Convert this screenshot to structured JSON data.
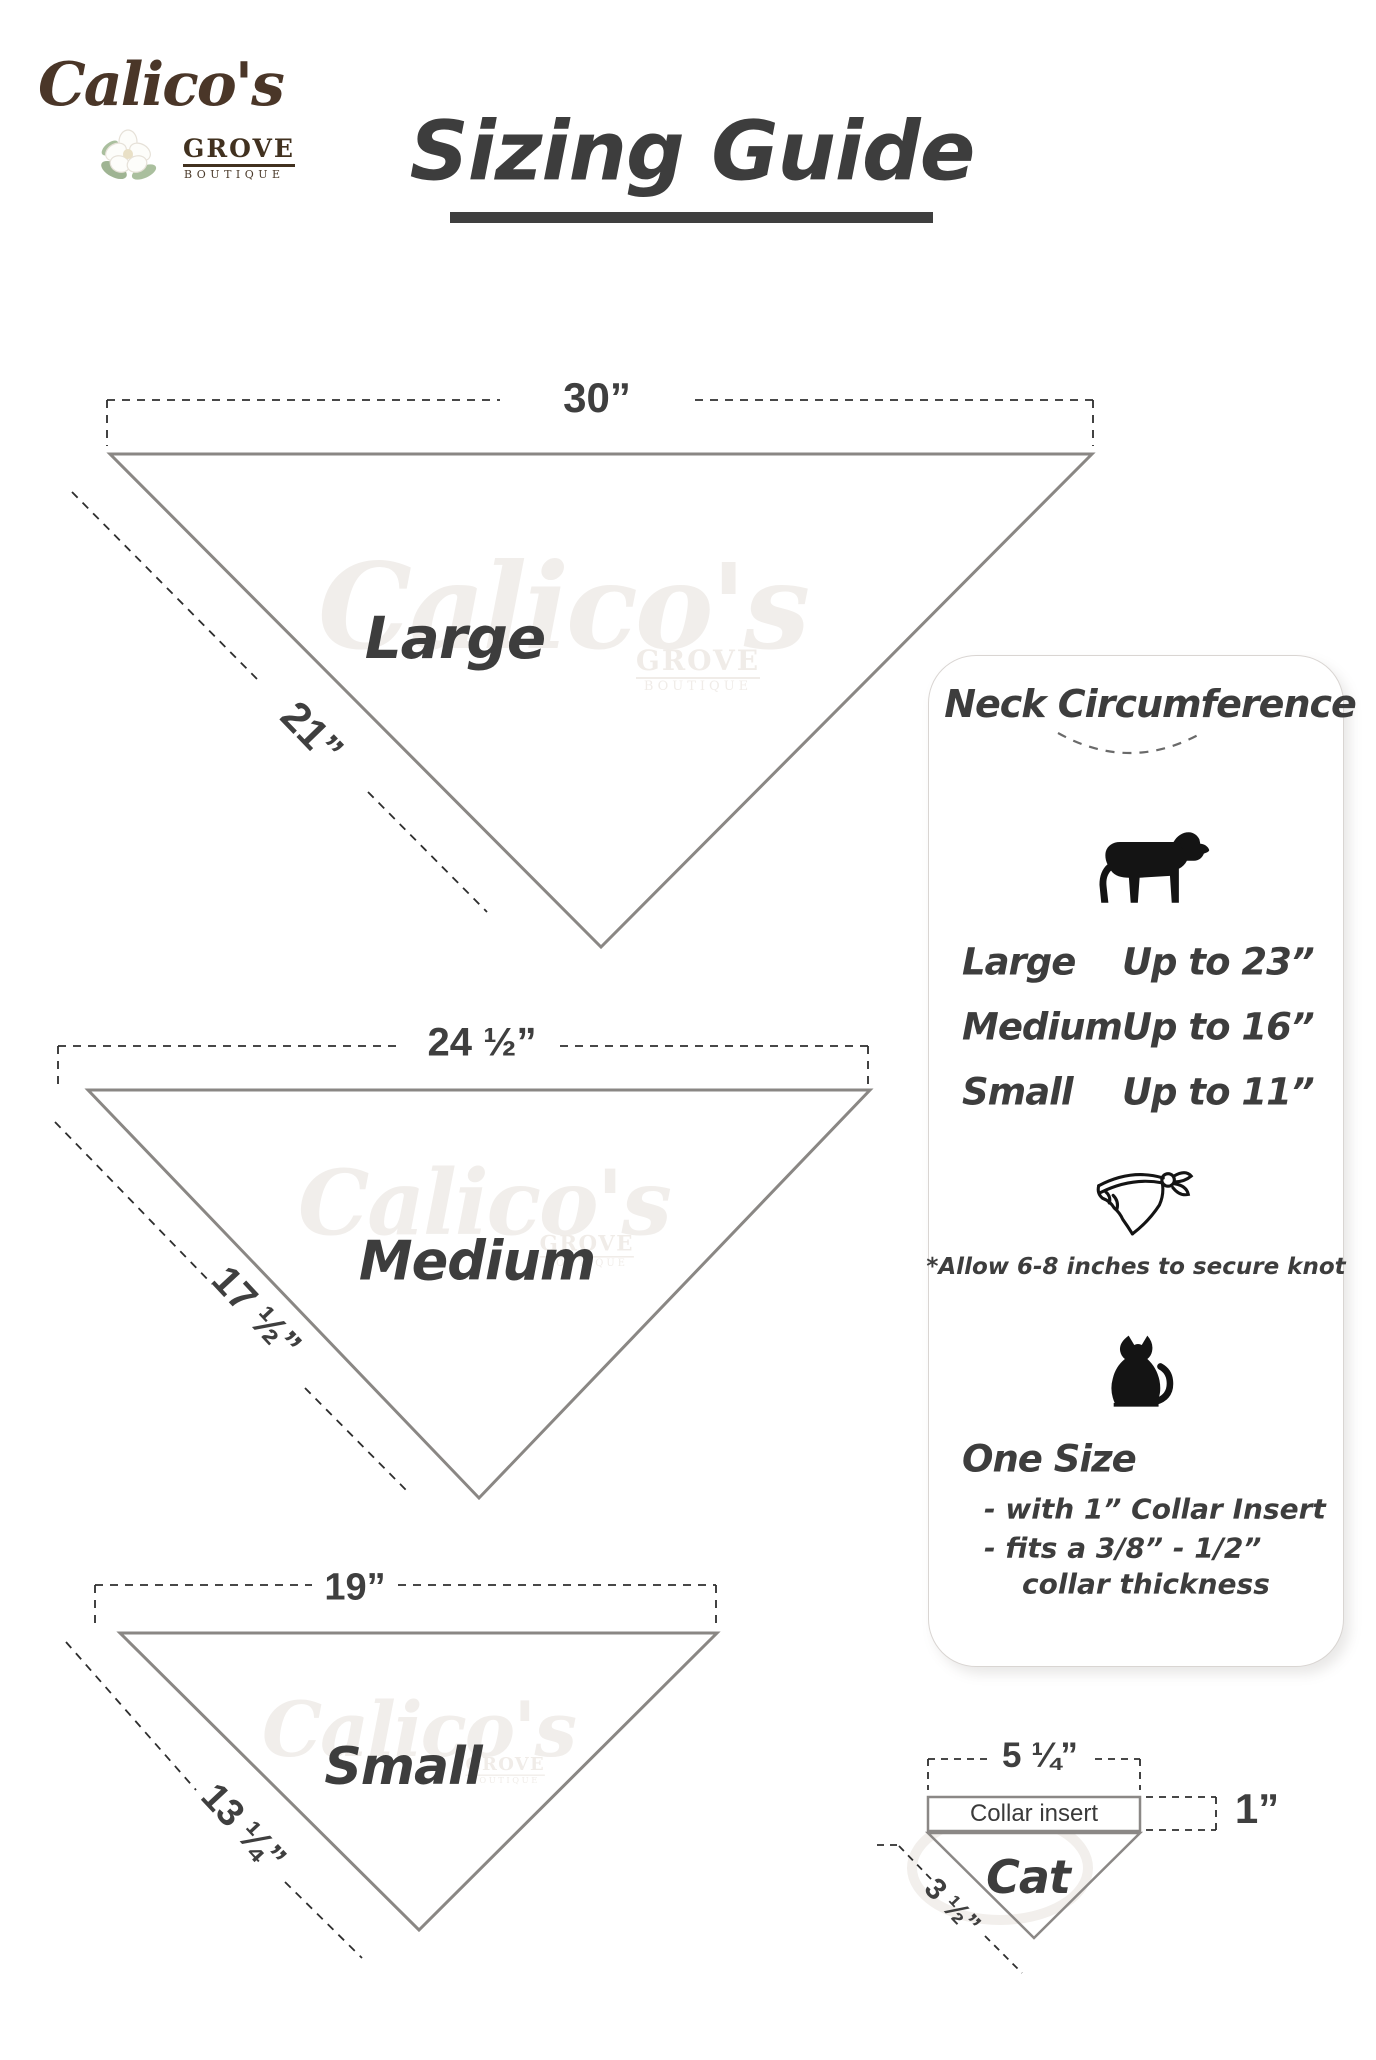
{
  "logo": {
    "brand": "Calico's",
    "grove": "GROVE",
    "boutique": "BOUTIQUE"
  },
  "title": {
    "text": "Sizing Guide"
  },
  "watermark": {
    "brand": "Calico's",
    "grove": "GROVE",
    "boutique": "BOUTIQUE"
  },
  "bandanas": {
    "large": {
      "name": "Large",
      "top_width": "30”",
      "side_length": "21”"
    },
    "medium": {
      "name": "Medium",
      "top_width": "24 ½”",
      "side_length": "17 ½”"
    },
    "small": {
      "name": "Small",
      "top_width": "19”",
      "side_length": "13 ¼”"
    }
  },
  "panel": {
    "heading": "Neck Circumference",
    "rows": [
      {
        "size": "Large",
        "value": "Up to 23”"
      },
      {
        "size": "Medium",
        "value": "Up to 16”"
      },
      {
        "size": "Small",
        "value": "Up to 11”"
      }
    ],
    "knot_note": "*Allow 6-8 inches to secure knot",
    "one_size": {
      "heading": "One Size",
      "line1": "- with 1” Collar Insert",
      "line2": "- fits a 3/8” - 1/2”",
      "line3": "collar thickness"
    }
  },
  "cat_diagram": {
    "top_width": "5 ¼”",
    "insert_label": "Collar insert",
    "insert_height": "1”",
    "name": "Cat",
    "side_length": "3 ½”"
  },
  "icons": {
    "dog": "dog-icon",
    "bandana": "bandana-icon",
    "cat": "cat-icon",
    "flower": "magnolia-flower-icon"
  },
  "colors": {
    "ink": "#3e3e3e",
    "triangle_outline": "#8a8784",
    "dash": "#2e2e2e",
    "brand_brown": "#4a3628",
    "watermark": "#f1eeeb",
    "icon_black": "#141414"
  }
}
